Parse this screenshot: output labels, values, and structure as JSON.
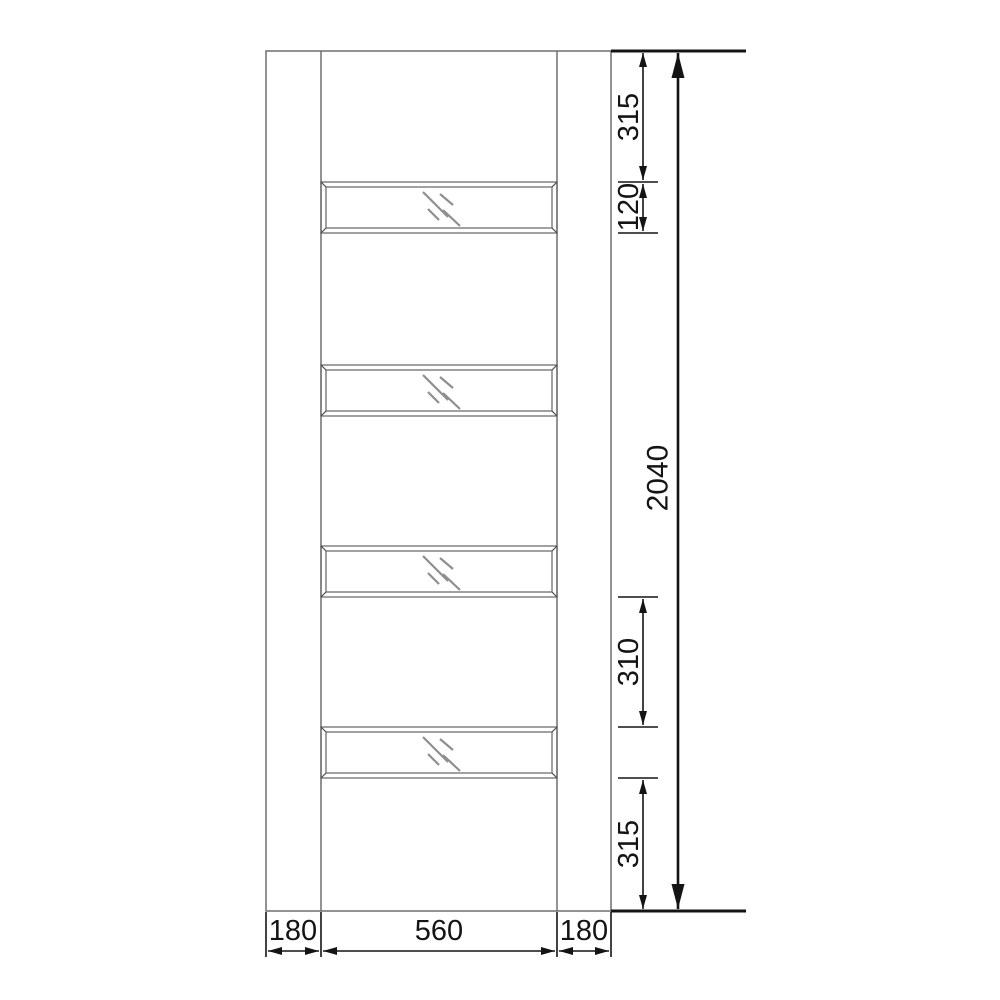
{
  "drawing": {
    "subject": "door-elevation-with-four-glazed-panels",
    "units": "mm",
    "glass_panel_count": 4,
    "labels": {
      "top_rail": "315",
      "pane_height": "120",
      "overall_height": "2040",
      "mid_rail": "310",
      "bottom_rail": "315",
      "left_stile": "180",
      "glazing_width": "560",
      "right_stile": "180"
    },
    "icons": {
      "glass_hatch": "diagonal-reflection-lines",
      "arrowhead": "filled-triangle"
    },
    "colors": {
      "background": "#ffffff",
      "door_outline": "#6e6e6e",
      "dimension_line": "#141414",
      "glass_hatch": "#8f8f8f"
    }
  }
}
